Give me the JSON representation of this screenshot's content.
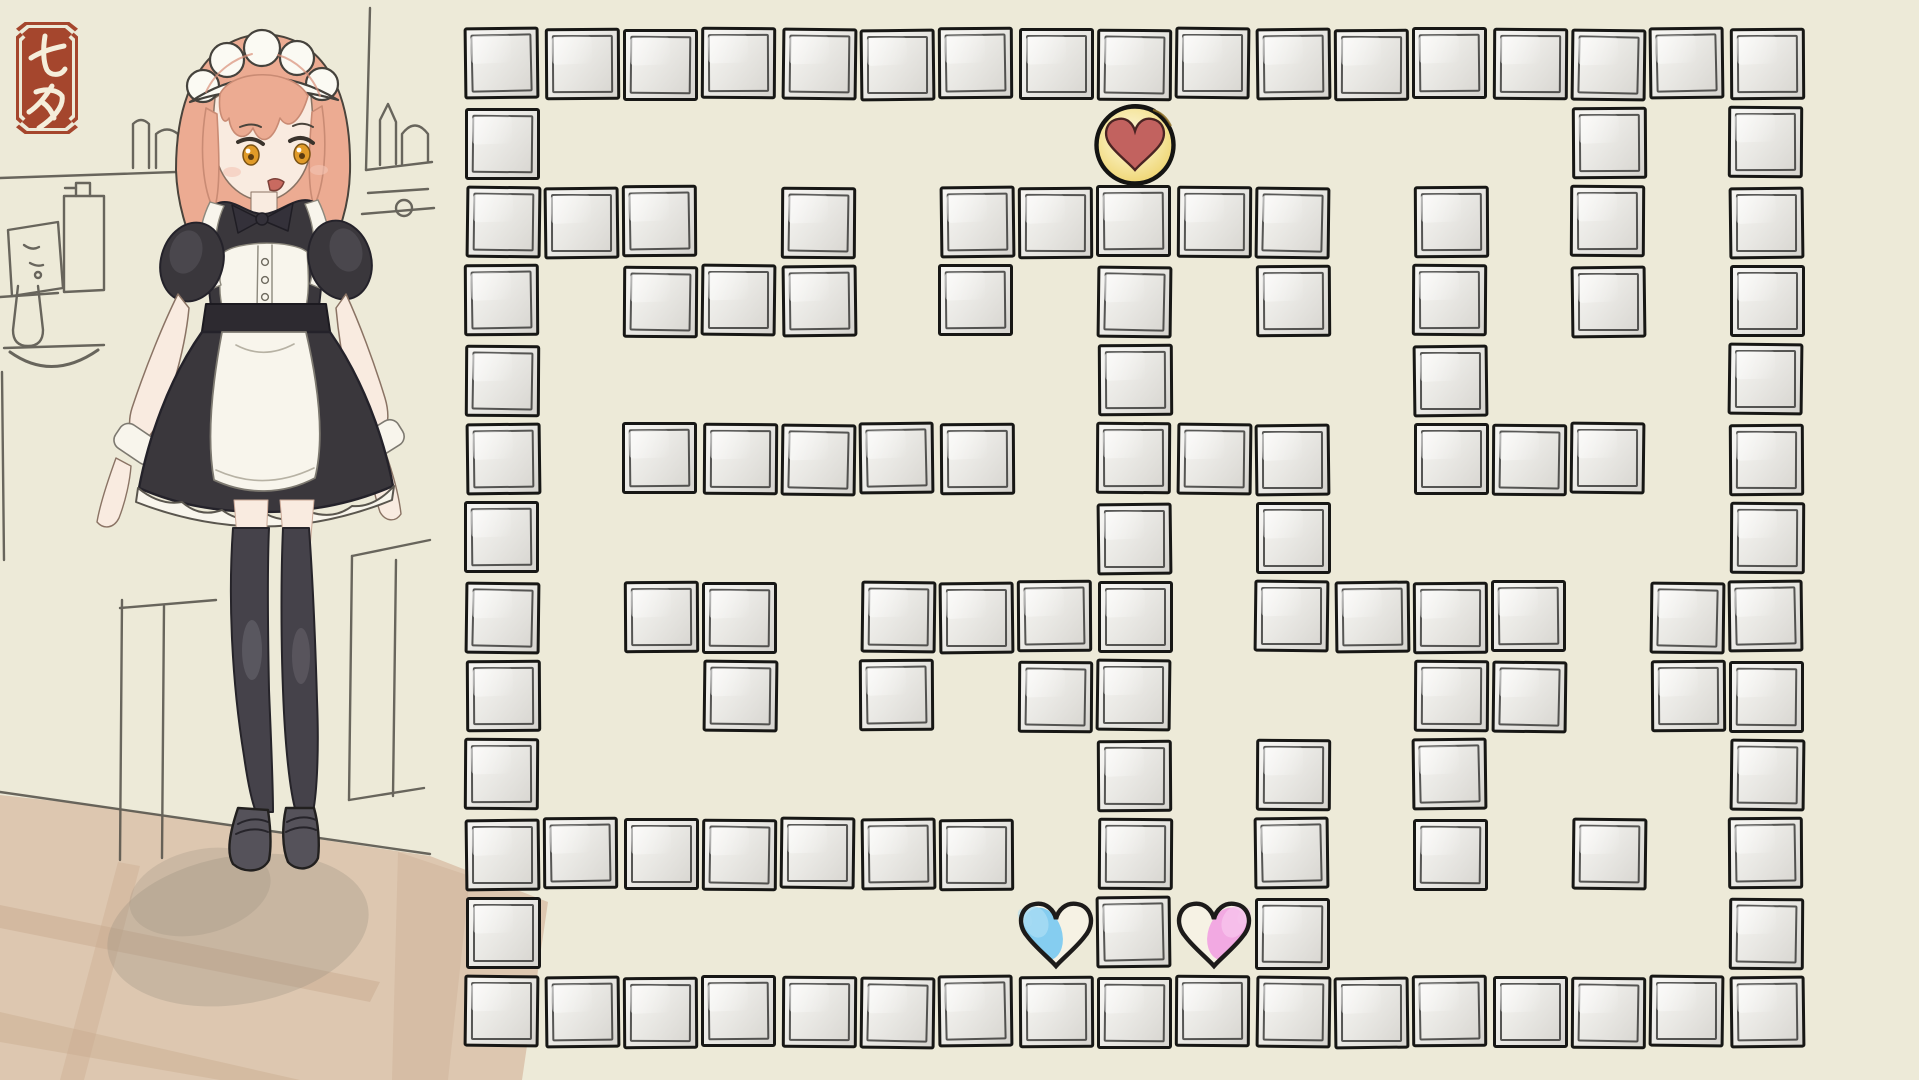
{
  "scene": {
    "background_color": "#edead8",
    "seal": {
      "characters": "七夕",
      "plaque_color": "#a5462d",
      "ink_color": "#f5eedb"
    },
    "character": {
      "description": "maid girl standing in sketched kitchen",
      "hair_color": "#ecab92",
      "hair_shade": "#d98f78",
      "skin_color": "#f9ebe0",
      "eye_color": "#e09a28",
      "dress_color": "#3a373c",
      "dress_dark": "#2d2a30",
      "apron_color": "#f8f5ec",
      "stocking_color": "#45424a",
      "stocking_light": "#6e6b74",
      "shoe_color": "#55525a",
      "sketch_line": "#56534b",
      "floor_color": "#dbc3ac",
      "floor_streak": "#c8a98d",
      "shadow_color": "#9b9184"
    },
    "maze": {
      "origin_x": 463,
      "origin_y": 25,
      "cell_size": 79,
      "columns": 17,
      "rows": 13,
      "block_fill_light": "#f5f4f1",
      "block_fill_mid": "#e9e8e4",
      "block_fill_dark": "#d8d6d1",
      "block_border": "#171715",
      "wall_rows": [
        "11111111111111111",
        "10000000000000101",
        "11101011111010101",
        "10111010101010101",
        "10000000100010001",
        "10111110111011101",
        "10000000101000001",
        "10110111101111011",
        "10010101100011011",
        "10000000101010001",
        "11111110101010101",
        "10000000101000001",
        "11111111111111111"
      ]
    },
    "tokens": {
      "goal": {
        "label": "red heart in gold coin",
        "row": 1,
        "col": 8,
        "heart_color": "#c2625f",
        "heart_edge": "#4a2423",
        "coin_color": "#eed36c",
        "coin_center": "#fbf6e2",
        "outline_color": "#141412"
      },
      "player_blue": {
        "label": "blue heart",
        "row": 11,
        "col": 7,
        "fill_color": "#85cdf0",
        "paper_color": "#f6f2e4",
        "outline_color": "#1d1b1a"
      },
      "player_pink": {
        "label": "pink heart",
        "row": 11,
        "col": 9,
        "fill_color": "#f2a9e2",
        "paper_color": "#f6f2e4",
        "outline_color": "#1d1b1a"
      }
    }
  }
}
